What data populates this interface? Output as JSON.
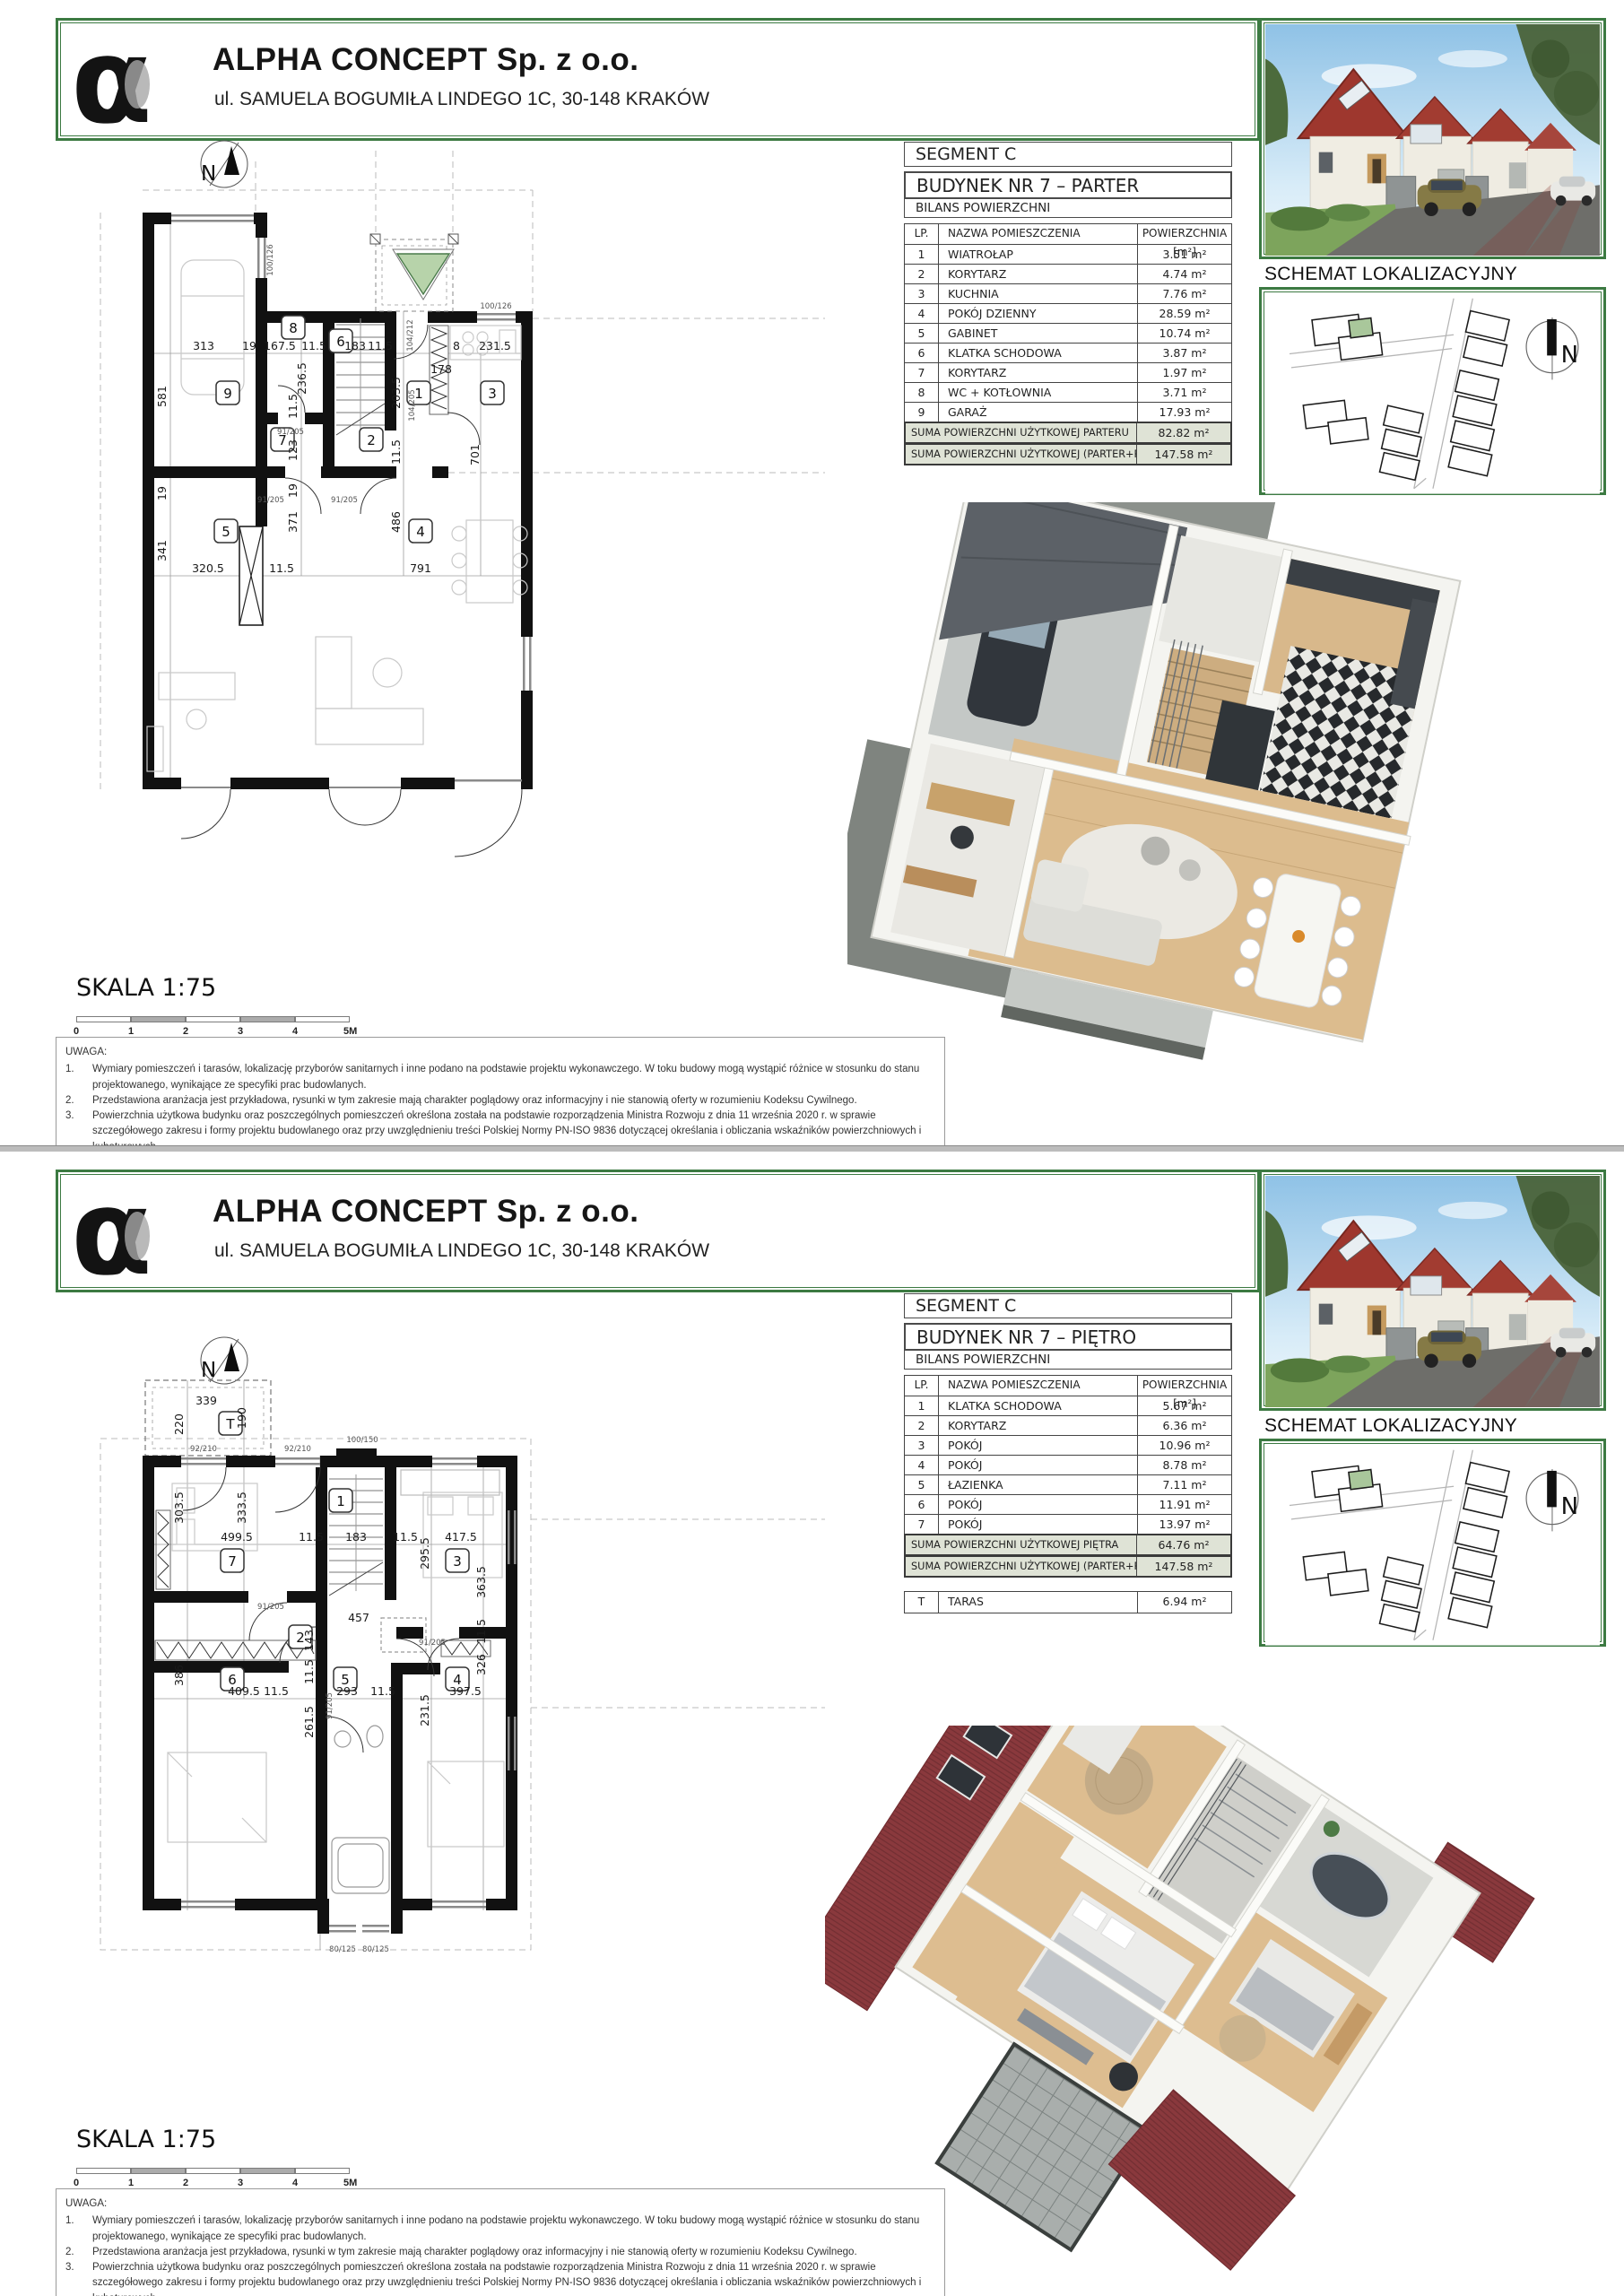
{
  "company": {
    "name": "ALPHA CONCEPT Sp. z o.o.",
    "address": "ul. SAMUELA BOGUMIŁA LINDEGO 1C, 30-148 KRAKÓW",
    "logo_glyph": "α"
  },
  "labels": {
    "segment": "SEGMENT C",
    "bilans": "BILANS POWIERZCHNI",
    "col_lp": "LP.",
    "col_name": "NAZWA POMIESZCZENIA",
    "col_area": "POWIERZCHNIA  [m²]",
    "schemat": "SCHEMAT LOKALIZACYJNY",
    "skala": "SKALA  1:75",
    "north": "N",
    "scale_ticks": [
      "0",
      "1",
      "2",
      "3",
      "4",
      "5M"
    ],
    "uwaga_title": "UWAGA:",
    "uwaga_numbers": [
      "1.",
      "2.",
      "3."
    ],
    "uwaga_items": [
      "Wymiary pomieszczeń i tarasów, lokalizację przyborów sanitarnych i inne podano na podstawie projektu wykonawczego. W toku budowy mogą wystąpić różnice w stosunku do stanu projektowanego, wynikające ze specyfiki prac budowlanych.",
      "Przedstawiona aranżacja jest przykładowa, rysunki w tym zakresie mają charakter poglądowy oraz informacyjny i nie stanowią oferty w rozumieniu Kodeksu Cywilnego.",
      "Powierzchnia użytkowa budynku oraz poszczególnych pomieszczeń określona została na podstawie rozporządzenia Ministra Rozwoju z dnia 11 września 2020 r. w sprawie szczegółowego zakresu i formy projektu budowlanego oraz przy uwzględnieniu treści Polskiej Normy PN-ISO 9836 dotyczącej określania i obliczania wskaźników powierzchniowych i kubaturowych."
    ],
    "colors": {
      "frame_green": "#3c7a42",
      "sum_row_bg": "#dfe3d6",
      "triangle_green": "#b7d3aa",
      "roof_red": "#8a393d"
    }
  },
  "parter": {
    "title": "BUDYNEK  NR 7 – PARTER",
    "rows": [
      {
        "lp": "1",
        "name": "WIATROŁAP",
        "area": "3.51 m²"
      },
      {
        "lp": "2",
        "name": "KORYTARZ",
        "area": "4.74 m²"
      },
      {
        "lp": "3",
        "name": "KUCHNIA",
        "area": "7.76 m²"
      },
      {
        "lp": "4",
        "name": "POKÓJ DZIENNY",
        "area": "28.59 m²"
      },
      {
        "lp": "5",
        "name": "GABINET",
        "area": "10.74 m²"
      },
      {
        "lp": "6",
        "name": "KLATKA SCHODOWA",
        "area": "3.87 m²"
      },
      {
        "lp": "7",
        "name": "KORYTARZ",
        "area": "1.97 m²"
      },
      {
        "lp": "8",
        "name": "WC + KOTŁOWNIA",
        "area": "3.71 m²"
      },
      {
        "lp": "9",
        "name": "GARAŻ",
        "area": "17.93 m²"
      }
    ],
    "sum1": {
      "label": "SUMA POWIERZCHNI UŻYTKOWEJ PARTERU",
      "value": "82.82 m²"
    },
    "sum2": {
      "label": "SUMA POWIERZCHNI UŻYTKOWEJ (PARTER+PIĘTRO)",
      "value": "147.58 m²"
    },
    "plan": {
      "badges": [
        "9",
        "8",
        "6",
        "1",
        "3",
        "7",
        "2",
        "5",
        "4"
      ],
      "dims": [
        "313",
        "19",
        "167.5",
        "11.5",
        "183",
        "11.5",
        "178",
        "8",
        "231.5",
        "581",
        "236.5",
        "11.5",
        "203.5",
        "123",
        "11.5",
        "19",
        "371",
        "486",
        "701",
        "341",
        "320.5",
        "11.5",
        "791",
        "19"
      ],
      "door_labels": [
        "100/126",
        "104/212",
        "100/126",
        "91/205",
        "91/205",
        "91/205",
        "104/205"
      ]
    }
  },
  "pietro": {
    "title": "BUDYNEK  NR 7 – PIĘTRO",
    "rows": [
      {
        "lp": "1",
        "name": "KLATKA SCHODOWA",
        "area": "5.67 m²"
      },
      {
        "lp": "2",
        "name": "KORYTARZ",
        "area": "6.36 m²"
      },
      {
        "lp": "3",
        "name": "POKÓJ",
        "area": "10.96 m²"
      },
      {
        "lp": "4",
        "name": "POKÓJ",
        "area": "8.78 m²"
      },
      {
        "lp": "5",
        "name": "ŁAZIENKA",
        "area": "7.11 m²"
      },
      {
        "lp": "6",
        "name": "POKÓJ",
        "area": "11.91 m²"
      },
      {
        "lp": "7",
        "name": "POKÓJ",
        "area": "13.97 m²"
      }
    ],
    "sum1": {
      "label": "SUMA POWIERZCHNI UŻYTKOWEJ PIĘTRA",
      "value": "64.76 m²"
    },
    "sum2": {
      "label": "SUMA POWIERZCHNI UŻYTKOWEJ (PARTER+PIĘTRO)",
      "value": "147.58 m²"
    },
    "taras": {
      "lp": "T",
      "name": "TARAS",
      "value": "6.94 m²"
    },
    "plan": {
      "badges": [
        "T",
        "7",
        "1",
        "3",
        "2",
        "6",
        "5",
        "4"
      ],
      "dims": [
        "339",
        "220",
        "190",
        "303.5",
        "333.5",
        "499.5",
        "11.5",
        "183",
        "11.5",
        "295.5",
        "417.5",
        "363.5",
        "457",
        "143",
        "11.5",
        "386",
        "409.5",
        "11.5",
        "293",
        "11.5",
        "261.5",
        "231.5",
        "326",
        "397.5",
        "11.5"
      ],
      "door_labels": [
        "92/210",
        "92/210",
        "100/150",
        "91/205",
        "91/205",
        "91/205",
        "80/125",
        "80/125"
      ]
    }
  }
}
